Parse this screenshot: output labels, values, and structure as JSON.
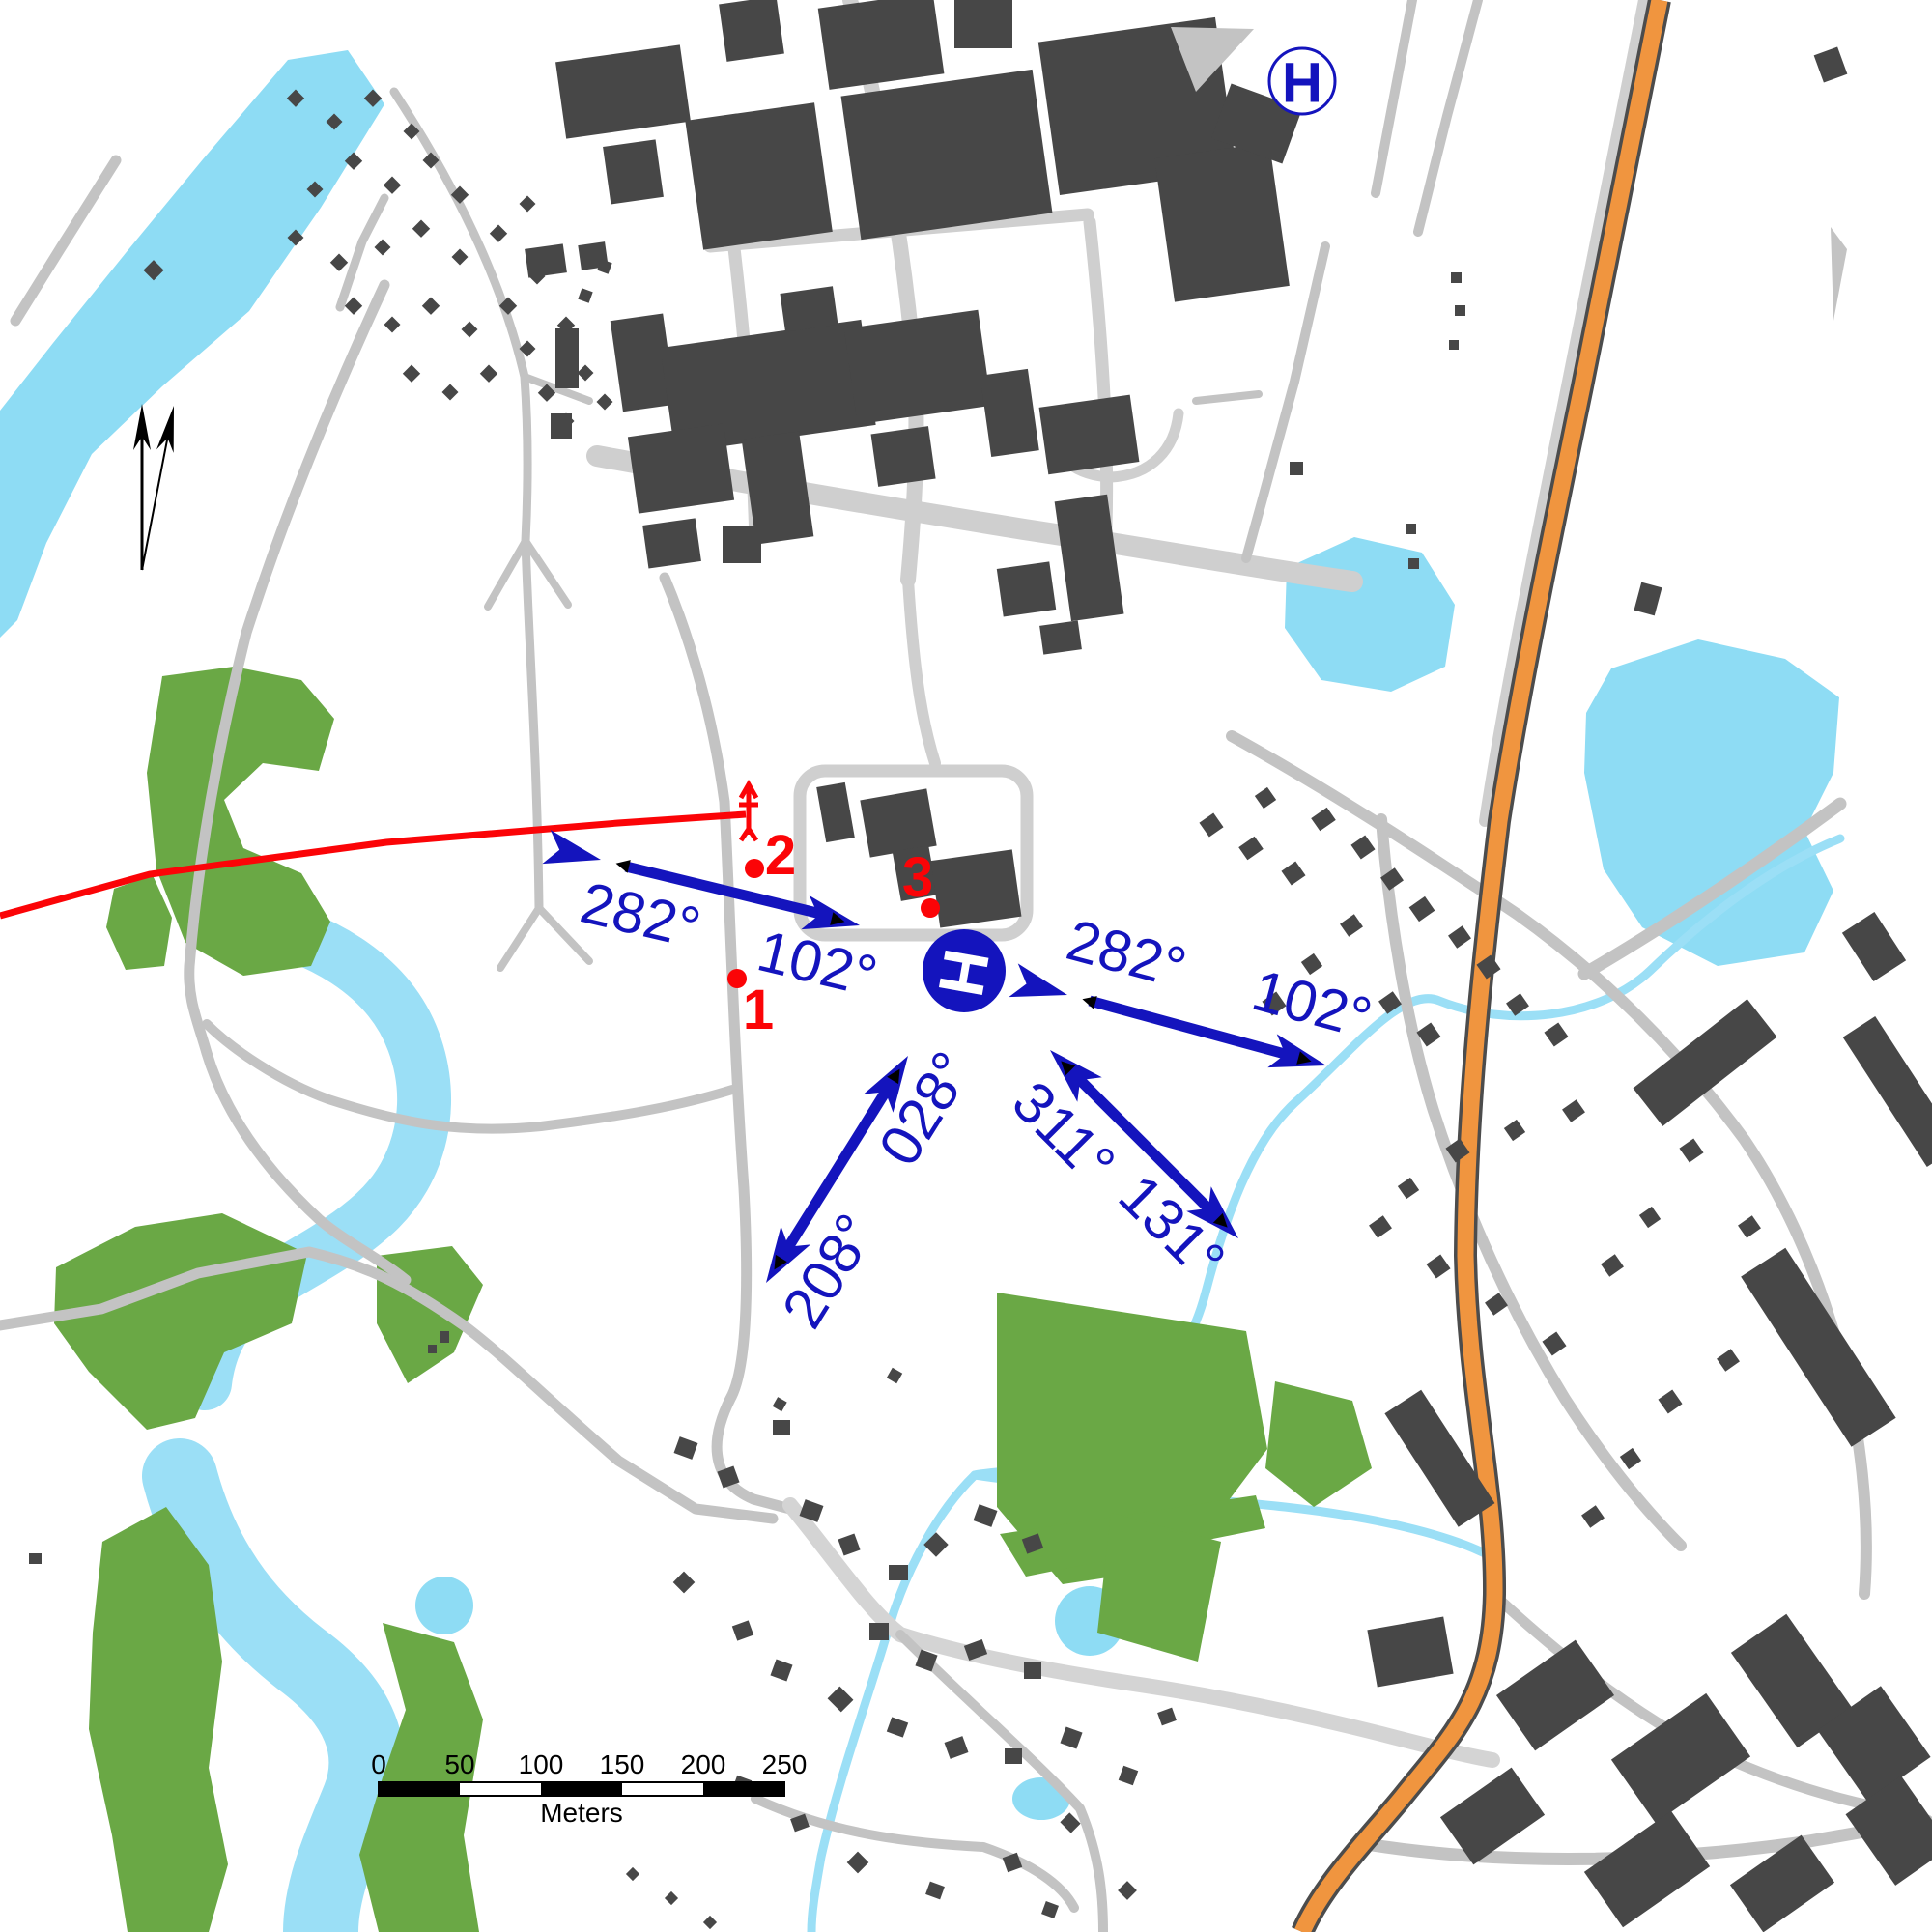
{
  "map": {
    "bearings": [
      {
        "id": "west-pair-reciprocal",
        "text": "282°"
      },
      {
        "id": "west-pair-heading",
        "text": "102°"
      },
      {
        "id": "east-pair-reciprocal",
        "text": "282°"
      },
      {
        "id": "east-pair-heading",
        "text": "102°"
      },
      {
        "id": "ne-heading",
        "text": "028°"
      },
      {
        "id": "sw-reciprocal",
        "text": "208°"
      },
      {
        "id": "nw-reciprocal",
        "text": "311°"
      },
      {
        "id": "se-heading",
        "text": "131°"
      }
    ],
    "points": [
      {
        "label": "1"
      },
      {
        "label": "2"
      },
      {
        "label": "3"
      }
    ],
    "helipad": {
      "label": "H"
    },
    "hospital": {
      "label": "H"
    },
    "scale_bar": {
      "tick_labels": [
        "0",
        "50",
        "100",
        "150",
        "200",
        "250"
      ],
      "unit_label": "Meters"
    },
    "colors": {
      "water": "#8edcf4",
      "stream": "#9bdff6",
      "green": "#6aa845",
      "road": "#c3c3c3",
      "paleroad": "#cfcfcf",
      "building": "#474747",
      "orange": "#f0953f",
      "orange_casing": "#4c4c4c",
      "blue": "#1414bd",
      "red": "#fb0407"
    }
  }
}
